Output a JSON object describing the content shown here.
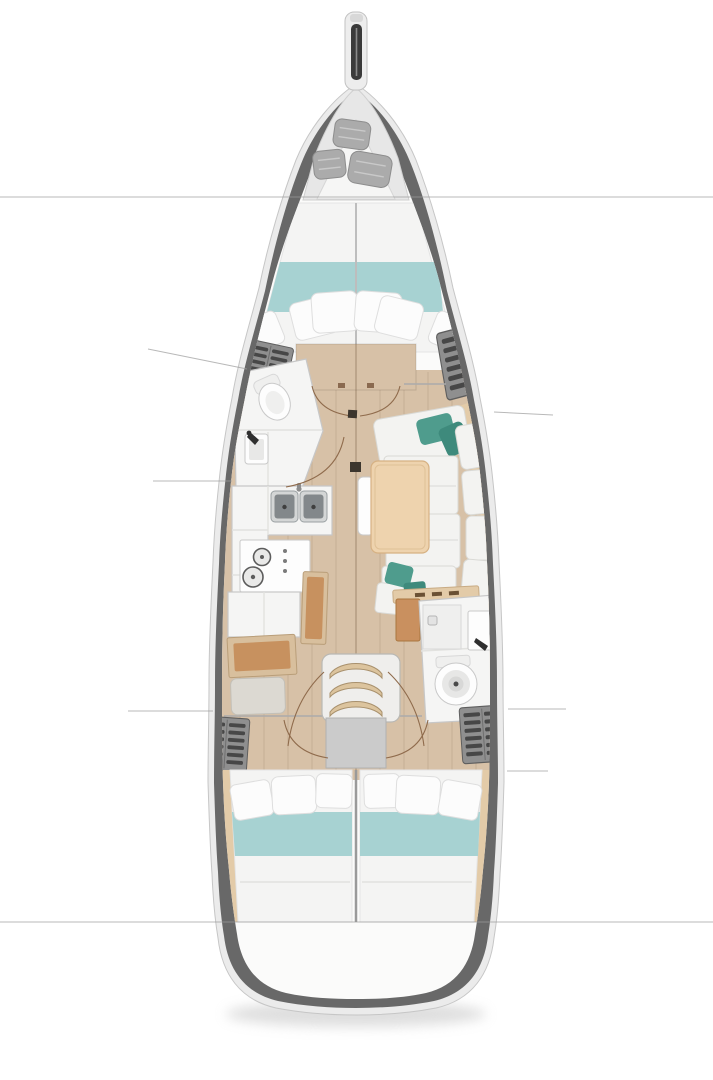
{
  "figure": {
    "type": "boat-floor-plan",
    "description": "Top-down interior layout plan of a sailing yacht, bow at top, stern at bottom. No text labels are rendered in the drawing.",
    "rooms": [
      "bow-anchor-locker",
      "forward-cabin",
      "forward-head",
      "galley",
      "salon-dinette",
      "nav-station",
      "companionway-stairs",
      "aft-head",
      "aft-cabin-port",
      "aft-cabin-starboard",
      "stern"
    ],
    "features": {
      "bow_locker_bags": 3,
      "forward_berth_pillows": 6,
      "galley_sinks": 2,
      "galley_burners": 2,
      "companionway_steps": 3,
      "heads": 2,
      "aft_cabins": 2,
      "aft_berth_pillows_per_cabin": 3,
      "salon_tables": 1,
      "wardrobe_lockers": 4,
      "section_lines_full_width": 2
    }
  },
  "palette": {
    "bg": "#ffffff",
    "hullRim": "#ebebeb",
    "hullRimStroke": "#c6c6c6",
    "hullWall": "#686868",
    "interior": "#fbfbfa",
    "bowDeck": "#e7e7e7",
    "lockerTriangle": "#f6f6f5",
    "bagGray": "#ababab",
    "floorWood": "#d7c1a7",
    "floorLine": "rgba(140,110,80,0.22)",
    "floorCenter": "rgba(120,95,70,0.35)",
    "bedWhite": "#f4f4f3",
    "bedTeal": "#a7d2d2",
    "pillowWhite": "#fcfcfc",
    "pillowStroke": "#dedede",
    "cushionWhite": "#f3f3f1",
    "cushionStroke": "#d9d9d5",
    "tealPillow": "#4f9c8d",
    "tealPillowDark": "#3e8a7c",
    "tableWood": "#eed3ae",
    "tableStroke": "#d6b183",
    "trimWood": "#e3cba8",
    "deskFrame": "#d8bf9d",
    "deskWood": "#c7915f",
    "benchGray": "#dcd9d2",
    "lockerBase": "#8f8f8f",
    "lockerSlat": "#474747",
    "fixtureWhite": "#f5f5f4",
    "fixtureStroke": "#c7c7c7",
    "steelLight": "#d4d6d6",
    "steelDark": "#83888b",
    "stairsWood": "#dcc49e",
    "stairsFrame": "#efeeec",
    "platformGray": "#cbcbcb",
    "sectionLine": "#9b9b9b",
    "doorArc": "#8f6b4c",
    "darkSquare": "#3c362e",
    "shadow": "#bdbdbd"
  }
}
